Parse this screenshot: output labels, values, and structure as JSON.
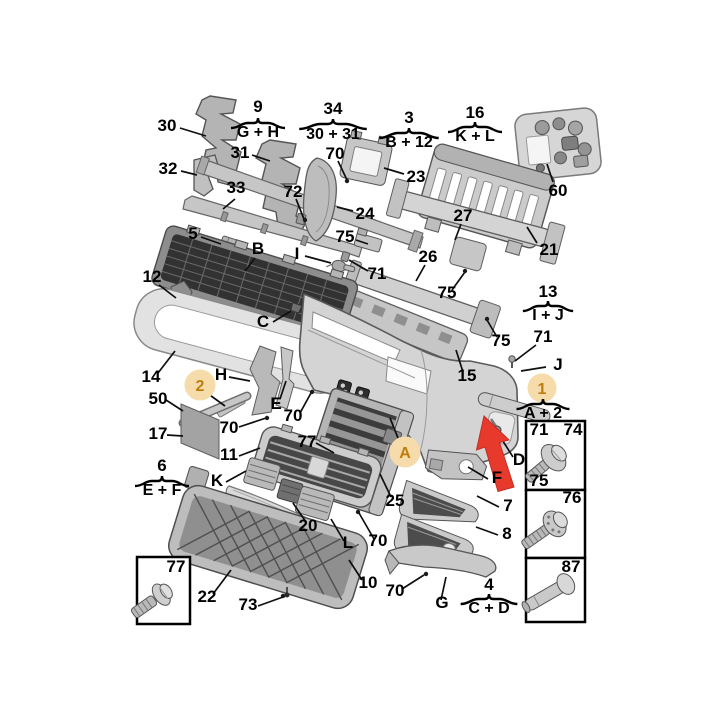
{
  "colors": {
    "background": "#ffffff",
    "label_text": "#000000",
    "highlight_circle_fill": "#f6dcab",
    "highlight_text": "#bf7d0e",
    "arrow_red": "#e8392d",
    "box_border": "#000000",
    "part_fill": "#c9c9c9",
    "part_stroke": "#5a5a5a",
    "grille_dark": "#3c3c3c"
  },
  "callouts": {
    "n1": "1",
    "n2": "2",
    "n3": "3",
    "n4": "4",
    "n5": "5",
    "n6": "6",
    "n7": "7",
    "n8": "8",
    "n9": "9",
    "n10": "10",
    "n11": "11",
    "n12": "12",
    "n13": "13",
    "n14": "14",
    "n15": "15",
    "n16": "16",
    "n17": "17",
    "n20": "20",
    "n21": "21",
    "n22": "22",
    "n23": "23",
    "n24": "24",
    "n25": "25",
    "n26": "26",
    "n27": "27",
    "n30": "30",
    "n31": "31",
    "n32": "32",
    "n33": "33",
    "n34": "34",
    "n50": "50",
    "n60": "60",
    "n70": "70",
    "n71": "71",
    "n72": "72",
    "n73": "73",
    "n74": "74",
    "n75": "75",
    "n76": "76",
    "n77": "77",
    "n87": "87"
  },
  "letters": {
    "A": "A",
    "B": "B",
    "C": "C",
    "D": "D",
    "E": "E",
    "F": "F",
    "G": "G",
    "H": "H",
    "I": "I",
    "J": "J",
    "K": "K",
    "L": "L"
  },
  "group_labels": {
    "g9": "G + H",
    "g34": "30 + 31",
    "g3": "B + 12",
    "g16": "K + L",
    "g13": "I + J",
    "g1": "A + 2",
    "g6": "E + F",
    "g4": "C + D"
  }
}
